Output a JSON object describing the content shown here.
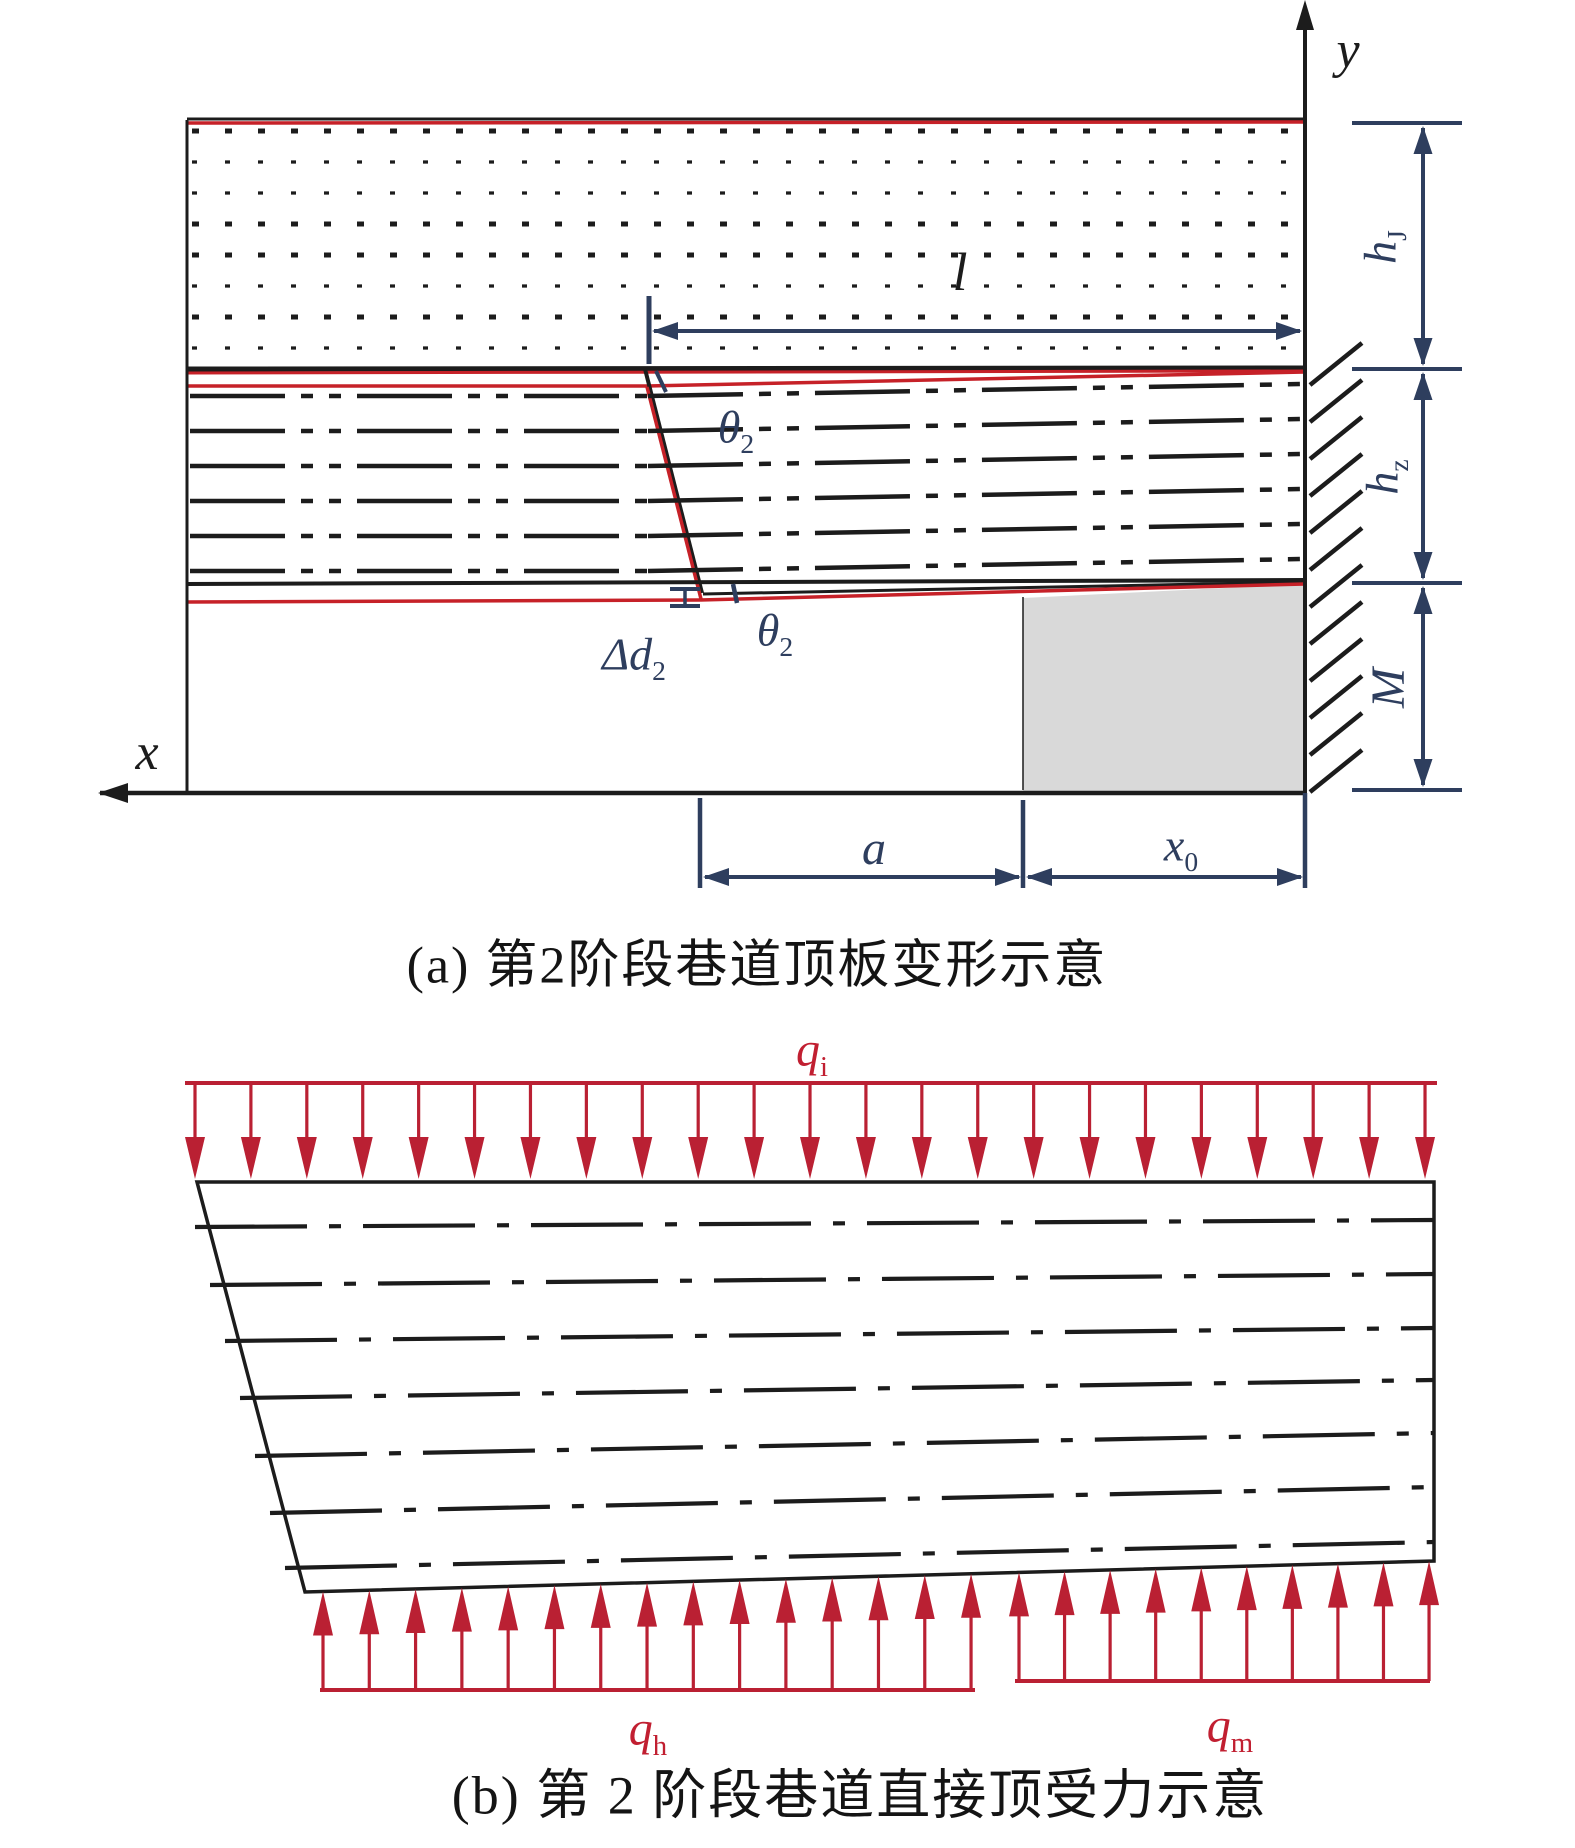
{
  "figure": {
    "caption_a": "(a) 第2阶段巷道顶板变形示意",
    "caption_b": "(b) 第 2 阶段巷道直接顶受力示意"
  },
  "labels": {
    "y_axis": {
      "text": "y"
    },
    "x_axis": {
      "text": "x"
    },
    "l_dim": {
      "text": "l"
    },
    "theta_upper": {
      "main": "θ",
      "sub": "2"
    },
    "theta_lower": {
      "main": "θ",
      "sub": "2"
    },
    "delta_d": {
      "main": "Δd",
      "sub": "2"
    },
    "a_dim": {
      "text": "a"
    },
    "x0_dim": {
      "main": "x",
      "sub": "0"
    },
    "h_j": {
      "main": "h",
      "sub": "J"
    },
    "h_z": {
      "main": "h",
      "sub": "z"
    },
    "m_dim": {
      "text": "M"
    },
    "q_i": {
      "main": "q",
      "sub": "i"
    },
    "q_h": {
      "main": "q",
      "sub": "h"
    },
    "q_m": {
      "main": "q",
      "sub": "m"
    }
  },
  "colors": {
    "black": "#1c1c1c",
    "red_line": "#c62128",
    "red_load": "#ba2033",
    "navy": "#2e3e5e",
    "gray_block": "#d9d9d9"
  },
  "geometry": {
    "width": 1575,
    "height": 1848,
    "palette": {
      "k": "#1c1c1c",
      "r": "#c62128",
      "r2": "#ba2033",
      "n": "#2e3e5e",
      "gray": "#d9d9d9",
      "white": "#ffffff"
    },
    "polygons": [
      {
        "pts": [
          [
            1023,
            598
          ],
          [
            1305,
            584
          ],
          [
            1305,
            791
          ],
          [
            1023,
            791
          ]
        ],
        "fill": "gray"
      },
      {
        "pts": [
          [
            98,
            793
          ],
          [
            128,
            783
          ],
          [
            128,
            803
          ]
        ],
        "fill": "k"
      },
      {
        "pts": [
          [
            1305,
            0
          ],
          [
            1296,
            30
          ],
          [
            1314,
            30
          ]
        ],
        "fill": "k"
      },
      {
        "pts": [
          [
            197,
            1182
          ],
          [
            1434,
            1182
          ],
          [
            1434,
            1561
          ],
          [
            305,
            1592
          ]
        ],
        "fill": "white",
        "stroke": "k",
        "w": 3.5
      }
    ],
    "lines": [
      [
        187,
        119,
        1305,
        119,
        "k",
        3
      ],
      [
        187,
        123,
        1305,
        122,
        "r",
        3.5
      ],
      [
        192,
        131,
        1300,
        131,
        "k",
        5,
        "7 26"
      ],
      [
        192,
        162,
        1300,
        162,
        "k",
        3.2,
        "5 28"
      ],
      [
        192,
        193,
        1300,
        193,
        "k",
        3.2,
        "5 28"
      ],
      [
        192,
        224,
        1300,
        224,
        "k",
        5,
        "7 26"
      ],
      [
        192,
        255,
        1300,
        255,
        "k",
        5,
        "7 26"
      ],
      [
        192,
        286,
        1300,
        286,
        "k",
        3.2,
        "5 28"
      ],
      [
        192,
        317,
        1300,
        317,
        "k",
        5,
        "7 26"
      ],
      [
        192,
        348,
        1300,
        348,
        "k",
        3.2,
        "5 28"
      ],
      [
        187,
        369,
        1305,
        368,
        "k",
        5
      ],
      [
        187,
        373,
        1305,
        371,
        "r",
        3
      ],
      [
        187,
        386,
        647,
        386,
        "r",
        3.5
      ],
      [
        647,
        386,
        1305,
        372,
        "r",
        3.5
      ],
      [
        645,
        369,
        702,
        593,
        "k",
        4
      ],
      [
        647,
        387,
        701,
        599,
        "r",
        3.5
      ],
      [
        190,
        396,
        648,
        396,
        "k",
        4.5,
        "95 16 12 16 12 16"
      ],
      [
        648,
        396,
        1303,
        384,
        "k",
        4.5,
        "95 16 12 16 12 16"
      ],
      [
        190,
        431,
        648,
        431,
        "k",
        4.5,
        "95 16 12 16 12 16"
      ],
      [
        648,
        431,
        1303,
        419,
        "k",
        4.5,
        "95 16 12 16 12 16"
      ],
      [
        190,
        466,
        648,
        466,
        "k",
        4.5,
        "95 16 12 16 12 16"
      ],
      [
        648,
        466,
        1303,
        454,
        "k",
        4.5,
        "95 16 12 16 12 16"
      ],
      [
        190,
        501,
        648,
        501,
        "k",
        4.5,
        "95 16 12 16 12 16"
      ],
      [
        648,
        501,
        1303,
        489,
        "k",
        4.5,
        "95 16 12 16 12 16"
      ],
      [
        190,
        536,
        648,
        536,
        "k",
        4.5,
        "95 16 12 16 12 16"
      ],
      [
        648,
        536,
        1303,
        524,
        "k",
        4.5,
        "95 16 12 16 12 16"
      ],
      [
        190,
        571,
        648,
        571,
        "k",
        4.5,
        "95 16 12 16 12 16"
      ],
      [
        648,
        571,
        1303,
        559,
        "k",
        4.5,
        "95 16 12 16 12 16"
      ],
      [
        187,
        584,
        1305,
        580,
        "k",
        4
      ],
      [
        703,
        594,
        1305,
        582,
        "k",
        3
      ],
      [
        187,
        602,
        700,
        600,
        "r",
        3.5
      ],
      [
        700,
        600,
        1305,
        584,
        "r",
        3.5
      ],
      [
        187,
        120,
        187,
        793,
        "k",
        3
      ],
      [
        1305,
        22,
        1305,
        793,
        "k",
        4
      ],
      [
        100,
        793,
        1305,
        793,
        "k",
        4.5
      ],
      [
        1023,
        597,
        1023,
        790,
        "k",
        1.5
      ],
      [
        1352,
        123,
        1462,
        123,
        "n",
        4
      ],
      [
        1352,
        369,
        1462,
        369,
        "n",
        4
      ],
      [
        1352,
        583,
        1462,
        583,
        "n",
        4
      ],
      [
        1352,
        790,
        1462,
        790,
        "n",
        4
      ],
      [
        649,
        296,
        649,
        364,
        "n",
        5
      ],
      [
        656,
        371,
        666,
        392,
        "n",
        4
      ],
      [
        733,
        584,
        737,
        603,
        "n",
        4.5
      ],
      [
        670,
        589,
        700,
        589,
        "n",
        4
      ],
      [
        685,
        589,
        685,
        606,
        "n",
        3.5
      ],
      [
        670,
        606,
        700,
        606,
        "n",
        4
      ],
      [
        700,
        798,
        700,
        888,
        "n",
        4.5
      ],
      [
        1023,
        800,
        1023,
        888,
        "n",
        4.5
      ],
      [
        1305,
        793,
        1305,
        888,
        "n",
        4.5
      ],
      [
        185,
        1083,
        1437,
        1083,
        "r2",
        4
      ],
      [
        320,
        1690,
        975,
        1690,
        "r2",
        4
      ],
      [
        1015,
        1681,
        1430,
        1681,
        "r2",
        4
      ],
      [
        195,
        1227,
        1434,
        1220,
        "k",
        4.2,
        "112 22 12 22"
      ],
      [
        210,
        1285,
        1434,
        1274,
        "k",
        4.2,
        "112 22 12 22"
      ],
      [
        225,
        1341,
        1434,
        1328,
        "k",
        4.2,
        "112 22 12 22"
      ],
      [
        240,
        1398,
        1434,
        1380,
        "k",
        4.2,
        "112 22 12 22"
      ],
      [
        255,
        1456,
        1434,
        1433,
        "k",
        4.2,
        "112 22 12 22"
      ],
      [
        270,
        1513,
        1434,
        1487,
        "k",
        4.2,
        "112 22 12 22"
      ],
      [
        285,
        1568,
        1434,
        1542,
        "k",
        4.2,
        "112 22 12 22"
      ]
    ],
    "hatch": {
      "x1": 1310,
      "x2": 1362,
      "dy": -42,
      "y0": 385,
      "step": 37,
      "count": 12,
      "w": 4.5
    },
    "arrow_groups": [
      {
        "dir": "down",
        "count": 23,
        "x0": 195,
        "dx": 55.91,
        "lineY": 1085,
        "tip0": 1179,
        "slope": 0,
        "headL": 42,
        "headW": 10,
        "stemW": 3.2,
        "color": "r2"
      },
      {
        "dir": "up",
        "count": 15,
        "x0": 323,
        "dx": 46.29,
        "lineY": 1690,
        "tip0": 1591.5,
        "slope": -0.02746,
        "headL": 44,
        "headW": 10,
        "stemW": 3.2,
        "color": "r2"
      },
      {
        "dir": "up",
        "count": 10,
        "x0": 1019,
        "dx": 45.56,
        "lineY": 1681,
        "tip0": 1572.4,
        "slope": -0.02746,
        "headL": 44,
        "headW": 10,
        "stemW": 3.2,
        "color": "r2"
      }
    ],
    "h_dims": [
      {
        "y": 331,
        "tipL": 652,
        "tipR": 1302
      },
      {
        "y": 877,
        "tipL": 703,
        "tipR": 1021
      },
      {
        "y": 877,
        "tipL": 1026,
        "tipR": 1303
      }
    ],
    "v_dims": [
      {
        "x": 1423,
        "tipT": 126,
        "tipB": 366
      },
      {
        "x": 1423,
        "tipT": 372,
        "tipB": 580
      },
      {
        "x": 1423,
        "tipT": 586,
        "tipB": 787
      }
    ]
  }
}
